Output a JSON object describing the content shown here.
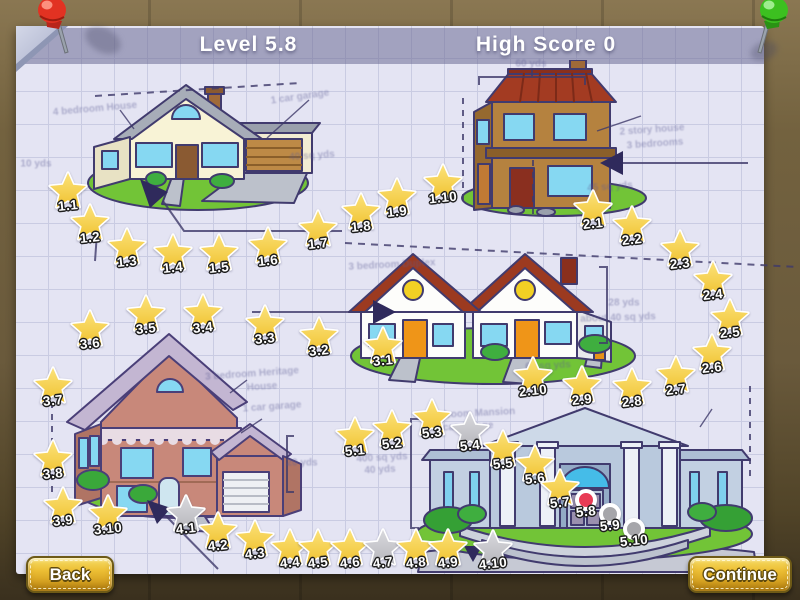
{
  "header": {
    "level": "Level 5.8",
    "high_score": "High Score 0"
  },
  "buttons": {
    "back": "Back",
    "continue": "Continue"
  },
  "colors": {
    "star_gold": "#f7d145",
    "star_gray": "#c7c7cb",
    "dot_current": "#e83b55",
    "dot_locked": "#a6a6aa",
    "paper": "#e4e4f3",
    "grid": "#c9cbe2",
    "ink": "#3f3a6a",
    "button_gold": "#ecbe34",
    "pin_red": "#e23222",
    "pin_green": "#3cc020"
  },
  "pins": [
    {
      "name": "red-pushpin",
      "color": "#e23222"
    },
    {
      "name": "green-pushpin",
      "color": "#3cc020"
    }
  ],
  "levels": [
    {
      "id": "1.1",
      "x": 68,
      "y": 190,
      "state": "star-gold"
    },
    {
      "id": "1.2",
      "x": 90,
      "y": 222,
      "state": "star-gold"
    },
    {
      "id": "1.3",
      "x": 127,
      "y": 246,
      "state": "star-gold"
    },
    {
      "id": "1.4",
      "x": 173,
      "y": 252,
      "state": "star-gold"
    },
    {
      "id": "1.5",
      "x": 219,
      "y": 252,
      "state": "star-gold"
    },
    {
      "id": "1.6",
      "x": 268,
      "y": 245,
      "state": "star-gold"
    },
    {
      "id": "1.7",
      "x": 318,
      "y": 228,
      "state": "star-gold"
    },
    {
      "id": "1.8",
      "x": 361,
      "y": 211,
      "state": "star-gold"
    },
    {
      "id": "1.9",
      "x": 397,
      "y": 196,
      "state": "star-gold"
    },
    {
      "id": "1.10",
      "x": 443,
      "y": 182,
      "state": "star-gold"
    },
    {
      "id": "2.1",
      "x": 593,
      "y": 208,
      "state": "star-gold"
    },
    {
      "id": "2.2",
      "x": 632,
      "y": 224,
      "state": "star-gold"
    },
    {
      "id": "2.3",
      "x": 680,
      "y": 248,
      "state": "star-gold"
    },
    {
      "id": "2.4",
      "x": 713,
      "y": 279,
      "state": "star-gold"
    },
    {
      "id": "2.5",
      "x": 730,
      "y": 317,
      "state": "star-gold"
    },
    {
      "id": "2.6",
      "x": 712,
      "y": 352,
      "state": "star-gold"
    },
    {
      "id": "2.7",
      "x": 676,
      "y": 374,
      "state": "star-gold"
    },
    {
      "id": "2.8",
      "x": 632,
      "y": 386,
      "state": "star-gold"
    },
    {
      "id": "2.9",
      "x": 582,
      "y": 384,
      "state": "star-gold"
    },
    {
      "id": "2.10",
      "x": 533,
      "y": 375,
      "state": "star-gold"
    },
    {
      "id": "3.1",
      "x": 383,
      "y": 345,
      "state": "star-gold"
    },
    {
      "id": "3.2",
      "x": 319,
      "y": 335,
      "state": "star-gold"
    },
    {
      "id": "3.3",
      "x": 265,
      "y": 323,
      "state": "star-gold"
    },
    {
      "id": "3.4",
      "x": 203,
      "y": 312,
      "state": "star-gold"
    },
    {
      "id": "3.5",
      "x": 146,
      "y": 313,
      "state": "star-gold"
    },
    {
      "id": "3.6",
      "x": 90,
      "y": 328,
      "state": "star-gold"
    },
    {
      "id": "3.7",
      "x": 53,
      "y": 385,
      "state": "star-gold"
    },
    {
      "id": "3.8",
      "x": 53,
      "y": 458,
      "state": "star-gold"
    },
    {
      "id": "3.9",
      "x": 63,
      "y": 505,
      "state": "star-gold"
    },
    {
      "id": "3.10",
      "x": 108,
      "y": 513,
      "state": "star-gold"
    },
    {
      "id": "4.1",
      "x": 186,
      "y": 513,
      "state": "star-gray"
    },
    {
      "id": "4.2",
      "x": 218,
      "y": 530,
      "state": "star-gold"
    },
    {
      "id": "4.3",
      "x": 255,
      "y": 538,
      "state": "star-gold"
    },
    {
      "id": "4.4",
      "x": 290,
      "y": 547,
      "state": "star-gold"
    },
    {
      "id": "4.5",
      "x": 318,
      "y": 547,
      "state": "star-gold"
    },
    {
      "id": "4.6",
      "x": 350,
      "y": 547,
      "state": "star-gold"
    },
    {
      "id": "4.7",
      "x": 383,
      "y": 547,
      "state": "star-gray"
    },
    {
      "id": "4.8",
      "x": 416,
      "y": 547,
      "state": "star-gold"
    },
    {
      "id": "4.9",
      "x": 448,
      "y": 547,
      "state": "star-gold"
    },
    {
      "id": "4.10",
      "x": 493,
      "y": 548,
      "state": "star-gray"
    },
    {
      "id": "5.1",
      "x": 355,
      "y": 435,
      "state": "star-gold"
    },
    {
      "id": "5.2",
      "x": 392,
      "y": 428,
      "state": "star-gold"
    },
    {
      "id": "5.3",
      "x": 432,
      "y": 417,
      "state": "star-gold"
    },
    {
      "id": "5.4",
      "x": 470,
      "y": 430,
      "state": "star-gray"
    },
    {
      "id": "5.5",
      "x": 503,
      "y": 448,
      "state": "star-gold"
    },
    {
      "id": "5.6",
      "x": 535,
      "y": 463,
      "state": "star-gold"
    },
    {
      "id": "5.7",
      "x": 560,
      "y": 487,
      "state": "star-gold"
    },
    {
      "id": "5.8",
      "x": 586,
      "y": 500,
      "state": "dot-current"
    },
    {
      "id": "5.9",
      "x": 610,
      "y": 514,
      "state": "dot-locked"
    },
    {
      "id": "5.10",
      "x": 634,
      "y": 529,
      "state": "dot-locked"
    }
  ],
  "annotations": [
    {
      "text": "4 bedroom House",
      "x": 95,
      "y": 109,
      "rot": -5
    },
    {
      "text": "1 car garage",
      "x": 300,
      "y": 97,
      "rot": -8
    },
    {
      "text": "40 sq yds",
      "x": 312,
      "y": 156,
      "rot": -4
    },
    {
      "text": "10 yds",
      "x": 36,
      "y": 164,
      "rot": 0
    },
    {
      "text": "60 yds",
      "x": 531,
      "y": 64,
      "rot": 0
    },
    {
      "text": "2 story house",
      "x": 652,
      "y": 130,
      "rot": -4
    },
    {
      "text": "3 bedrooms",
      "x": 655,
      "y": 144,
      "rot": -4
    },
    {
      "text": "45 sq yds",
      "x": 610,
      "y": 187,
      "rot": -4
    },
    {
      "text": "3 bedroom Duplex",
      "x": 392,
      "y": 265,
      "rot": -3
    },
    {
      "text": "28 yds",
      "x": 624,
      "y": 303,
      "rot": 0
    },
    {
      "text": "about 40 sq yds",
      "x": 618,
      "y": 318,
      "rot": -2
    },
    {
      "text": "60 sq yds",
      "x": 548,
      "y": 366,
      "rot": -3
    },
    {
      "text": "3 bedroom Heritage",
      "x": 252,
      "y": 374,
      "rot": -4
    },
    {
      "text": "House",
      "x": 262,
      "y": 387,
      "rot": -4
    },
    {
      "text": "1 car garage",
      "x": 272,
      "y": 407,
      "rot": -4
    },
    {
      "text": "20 yds",
      "x": 302,
      "y": 463,
      "rot": 0
    },
    {
      "text": "400 sq yds",
      "x": 382,
      "y": 458,
      "rot": -3
    },
    {
      "text": "40 yds",
      "x": 380,
      "y": 470,
      "rot": -3
    },
    {
      "text": "4 bedroom Mansion",
      "x": 468,
      "y": 414,
      "rot": -3
    },
    {
      "text": "2 car garage",
      "x": 464,
      "y": 427,
      "rot": -3
    }
  ]
}
